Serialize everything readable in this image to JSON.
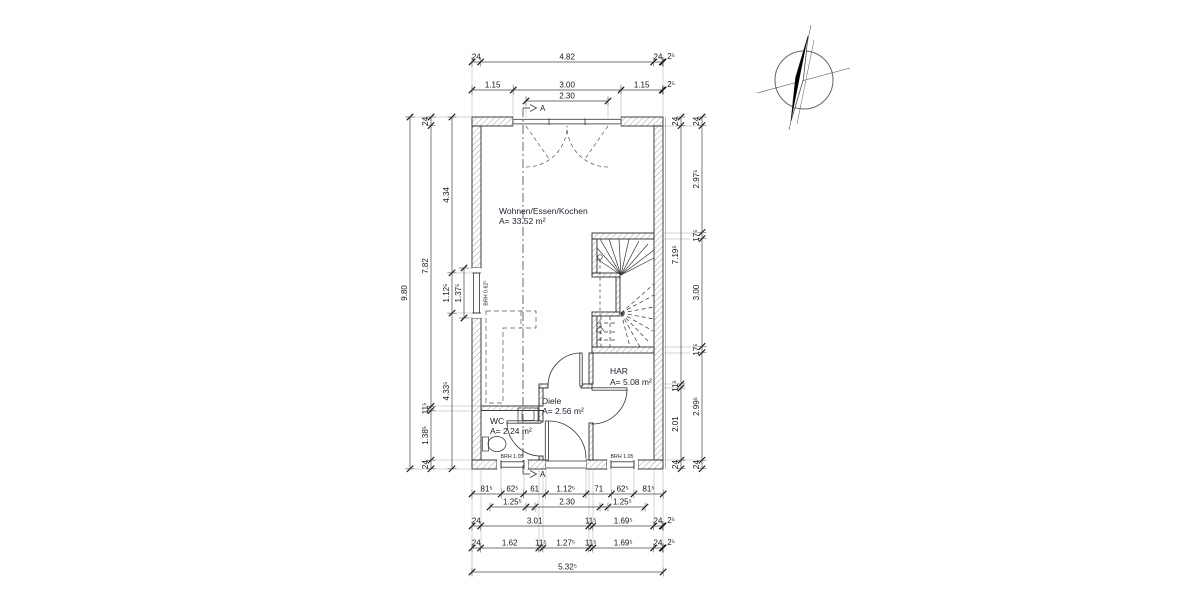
{
  "drawing": {
    "kind": "Grundriss / floor plan",
    "scale_px_per_m": 35.9
  },
  "rooms": [
    {
      "name": "Wohnen/Essen/Kochen",
      "area": "A= 33.52 m²"
    },
    {
      "name": "HAR",
      "area": "A= 5.08 m²"
    },
    {
      "name": "Diele",
      "area": "A= 2.56 m²"
    },
    {
      "name": "WC",
      "area": "A= 2.24 m²"
    }
  ],
  "annotations": {
    "section_marker": "A",
    "brh_window_left": "BRH 0.62⁵",
    "brh_window_wc": "BRH 1.05",
    "brh_window_har": "BRH 1.05"
  },
  "dims": {
    "top_a": [
      "24",
      "4.82",
      "24",
      "2⁵"
    ],
    "top_b": [
      "1.15",
      "3.00",
      "1.15",
      "2⁵"
    ],
    "top_sub": [
      "2.30"
    ],
    "left_total": [
      "9.80"
    ],
    "left_mid": [
      "24",
      "7.82",
      "11⁵",
      "1.38⁵",
      "24"
    ],
    "left_inner": [
      "4.34",
      "1.12⁵",
      "4.33⁵"
    ],
    "left_opening": [
      "1.37⁵"
    ],
    "right_inner": [
      "24",
      "7.19⁵",
      "11⁵",
      "2.01",
      "24"
    ],
    "right_outer": [
      "24",
      "2.97⁵",
      "17⁵",
      "3.00",
      "17⁵",
      "2.99⁵",
      "24"
    ],
    "bottom_1": [
      "81⁵",
      "62⁵",
      "61",
      "1.12⁵",
      "71",
      "62⁵",
      "81⁵"
    ],
    "bottom_sub": [
      "1.25⁵",
      "2.30",
      "1.25⁵"
    ],
    "bottom_2": [
      "24",
      "3.01",
      "11⁵",
      "1.69⁵",
      "24",
      "2⁵"
    ],
    "bottom_3": [
      "24",
      "1.62",
      "11⁵",
      "1.27⁵",
      "11⁵",
      "1.69⁵",
      "24",
      "2⁵"
    ],
    "bottom_total": [
      "5.32⁵"
    ]
  }
}
